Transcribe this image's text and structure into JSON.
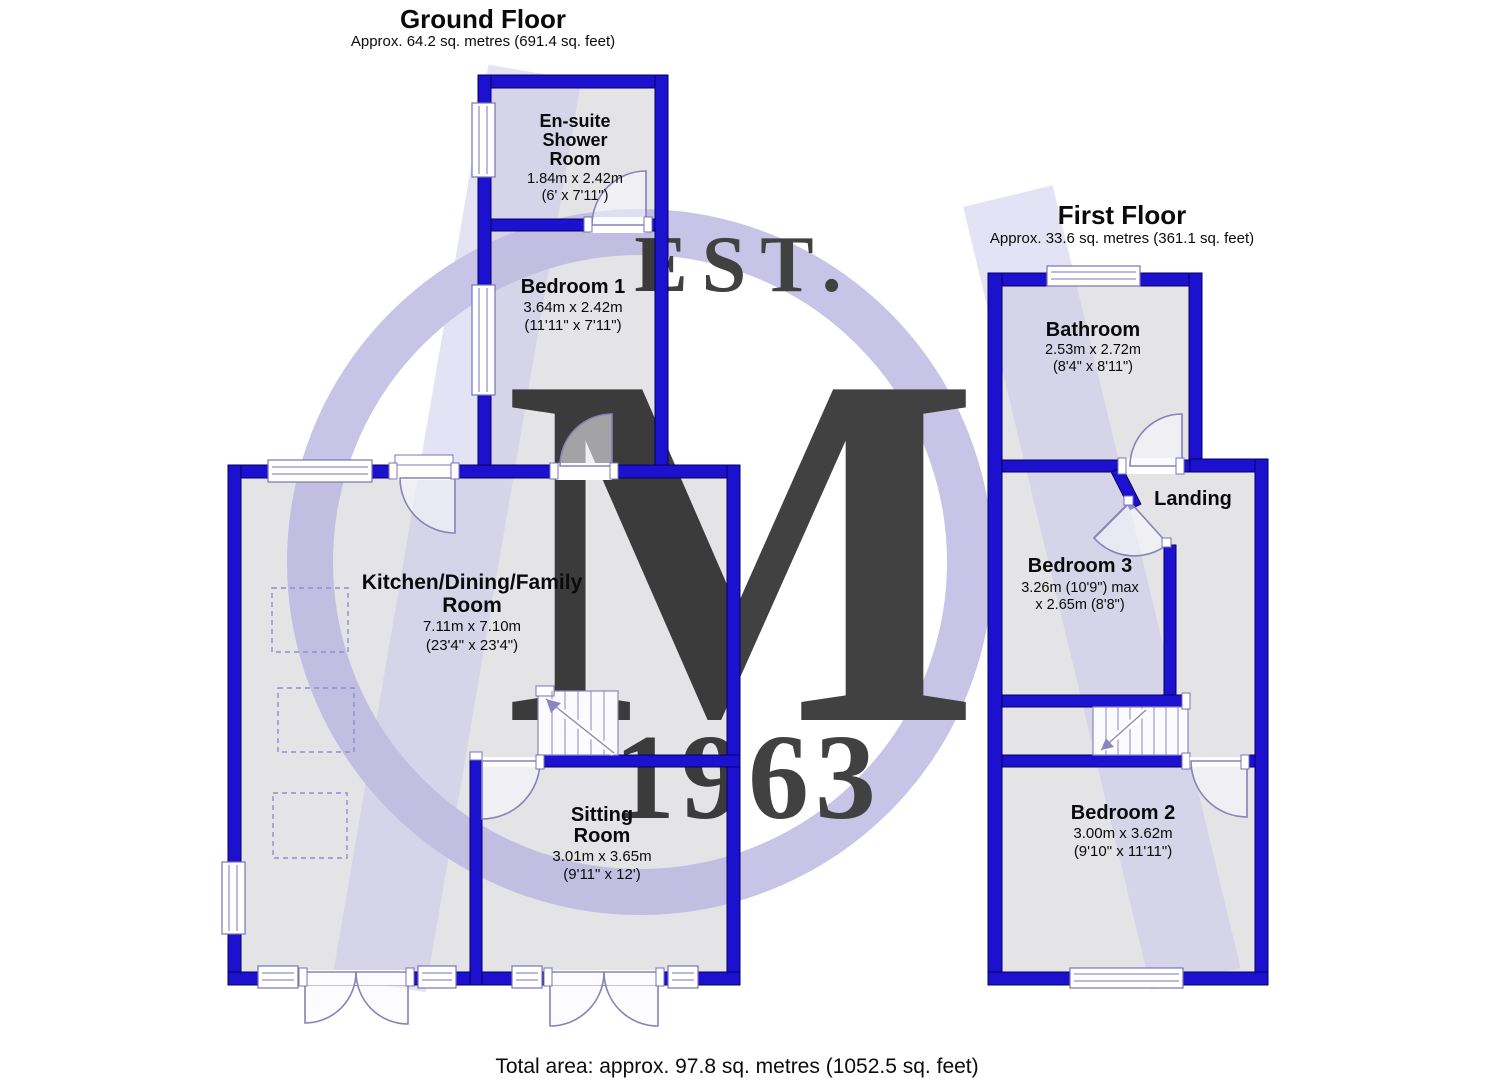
{
  "colors": {
    "wall": "#1c11cf",
    "watermark": "#b9b4e0",
    "ribbon": "#c7c3ea",
    "floor": "#e4e3e6"
  },
  "watermark": {
    "est": "EST.",
    "monogram": "M",
    "year": "1963"
  },
  "ground": {
    "title": "Ground Floor",
    "subtitle": "Approx. 64.2 sq. metres (691.4 sq. feet)",
    "rooms": {
      "ensuite": {
        "l1": "En-suite",
        "l2": "Shower",
        "l3": "Room",
        "d1": "1.84m x 2.42m",
        "d2": "(6' x 7'11\")"
      },
      "bedroom1": {
        "name": "Bedroom 1",
        "d1": "3.64m x 2.42m",
        "d2": "(11'11\" x 7'11\")"
      },
      "kitchen": {
        "l1": "Kitchen/Dining/Family",
        "l2": "Room",
        "d1": "7.11m x 7.10m",
        "d2": "(23'4\" x 23'4\")"
      },
      "sitting": {
        "l1": "Sitting",
        "l2": "Room",
        "d1": "3.01m x 3.65m",
        "d2": "(9'11\" x 12')"
      }
    }
  },
  "first": {
    "title": "First Floor",
    "subtitle": "Approx. 33.6 sq. metres (361.1 sq. feet)",
    "rooms": {
      "bathroom": {
        "name": "Bathroom",
        "d1": "2.53m x 2.72m",
        "d2": "(8'4\" x 8'11\")"
      },
      "landing": {
        "name": "Landing"
      },
      "bedroom3": {
        "name": "Bedroom 3",
        "d1": "3.26m (10'9\") max",
        "d2": "x 2.65m (8'8\")"
      },
      "bedroom2": {
        "name": "Bedroom 2",
        "d1": "3.00m x 3.62m",
        "d2": "(9'10\" x 11'11\")"
      }
    }
  },
  "footer": {
    "total": "Total area: approx. 97.8 sq. metres (1052.5 sq. feet)"
  }
}
